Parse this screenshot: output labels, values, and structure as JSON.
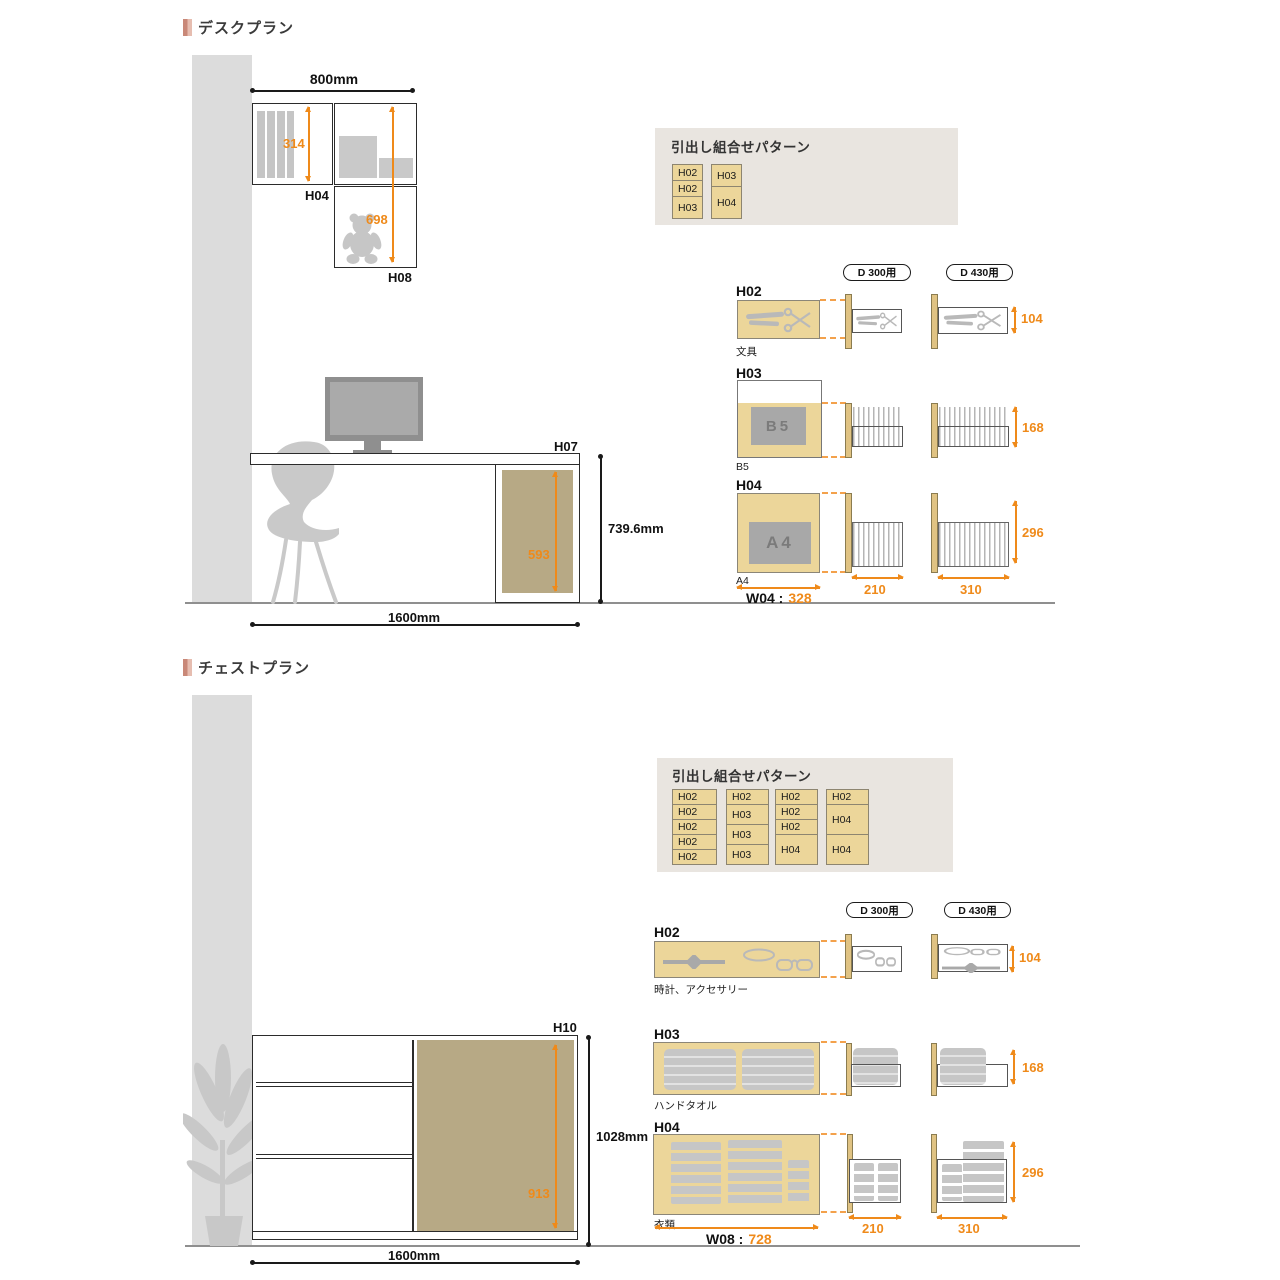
{
  "colors": {
    "accent_orange": "#ef8a1a",
    "drawer_tan": "#ecd69a",
    "side_bar_tan": "#e0c383",
    "panel_khaki": "#b7a985",
    "wall_gray": "#dcdcdc",
    "silhouette_gray": "#c9c9c9",
    "pattern_box_bg": "#e9e5e0",
    "title_accent_pink": "#c98878"
  },
  "desk": {
    "title": "デスクプラン",
    "shelf": {
      "width": "800mm",
      "inner_height": "314",
      "right_height": "698",
      "label_h04": "H04",
      "label_h08": "H08"
    },
    "scene": {
      "label_h07": "H07",
      "height": "739.6mm",
      "width": "1600mm",
      "panel_height": "593"
    },
    "pattern": {
      "title": "引出し組合せパターン",
      "columns": [
        [
          "H02",
          "H02",
          "H03"
        ],
        [
          "H03",
          "H04"
        ]
      ]
    },
    "depth_headers": [
      "D 300用",
      "D 430用"
    ],
    "rows": {
      "h02": {
        "label": "H02",
        "caption": "文具",
        "height": "104"
      },
      "h03": {
        "label": "H03",
        "caption": "B5",
        "content": "B5",
        "height": "168"
      },
      "h04": {
        "label": "H04",
        "caption": "A4",
        "content": "A4",
        "height": "296",
        "width_label": "W04 :",
        "width_value": "328",
        "d300_width": "210",
        "d430_width": "310"
      }
    }
  },
  "chest": {
    "title": "チェストプラン",
    "scene": {
      "label_h10": "H10",
      "height": "1028mm",
      "width": "1600mm",
      "panel_height": "913"
    },
    "pattern": {
      "title": "引出し組合せパターン",
      "columns": [
        [
          "H02",
          "H02",
          "H02",
          "H02",
          "H02"
        ],
        [
          "H02",
          "H03",
          "H03",
          "H03"
        ],
        [
          "H02",
          "H02",
          "H02",
          "H04"
        ],
        [
          "H02",
          "H04",
          "H04"
        ]
      ]
    },
    "depth_headers": [
      "D 300用",
      "D 430用"
    ],
    "rows": {
      "h02": {
        "label": "H02",
        "caption": "時計、アクセサリー",
        "height": "104"
      },
      "h03": {
        "label": "H03",
        "caption": "ハンドタオル",
        "height": "168"
      },
      "h04": {
        "label": "H04",
        "caption": "衣類",
        "height": "296",
        "width_label": "W08 :",
        "width_value": "728",
        "d300_width": "210",
        "d430_width": "310"
      }
    }
  }
}
